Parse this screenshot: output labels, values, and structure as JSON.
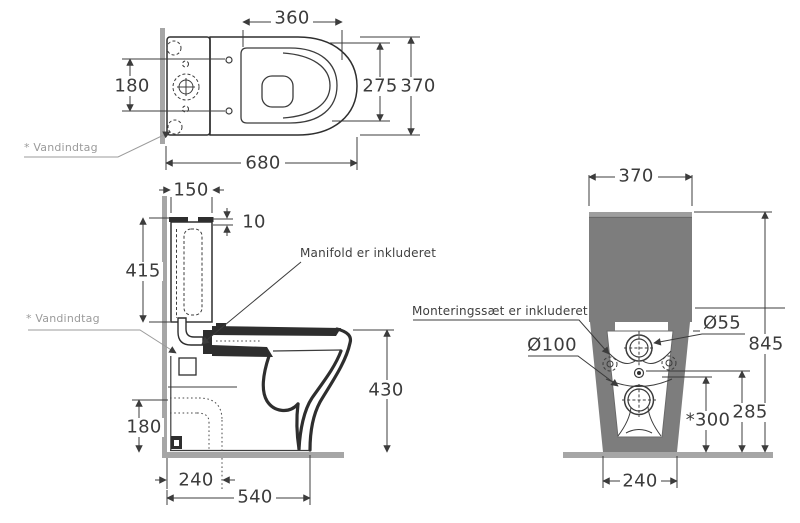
{
  "drawing": {
    "colors": {
      "line": "#3c3c3c",
      "heavy_line": "#2e2e2e",
      "fill_gray": "#7d7d7d",
      "light_gray_band": "#9e9e9e",
      "wall_gray": "#a6a6a6",
      "note_gray": "#9b9b9b"
    },
    "top_view": {
      "d360": "360",
      "d180": "180",
      "d275": "275",
      "d370": "370",
      "d680": "680",
      "note_inlet": "* Vandindtag"
    },
    "side_view": {
      "d150": "150",
      "d10": "10",
      "d415": "415",
      "d430": "430",
      "d180": "180",
      "d240": "240",
      "d540": "540",
      "note_inlet": "* Vandindtag",
      "note_manifold": "Manifold er inkluderet"
    },
    "front_view": {
      "d370": "370",
      "d845": "845",
      "d55": "Ø55",
      "d100": "Ø100",
      "d285": "285",
      "d300": "*300",
      "d240": "240",
      "note_mounting": "Monteringssæt er inkluderet"
    }
  }
}
